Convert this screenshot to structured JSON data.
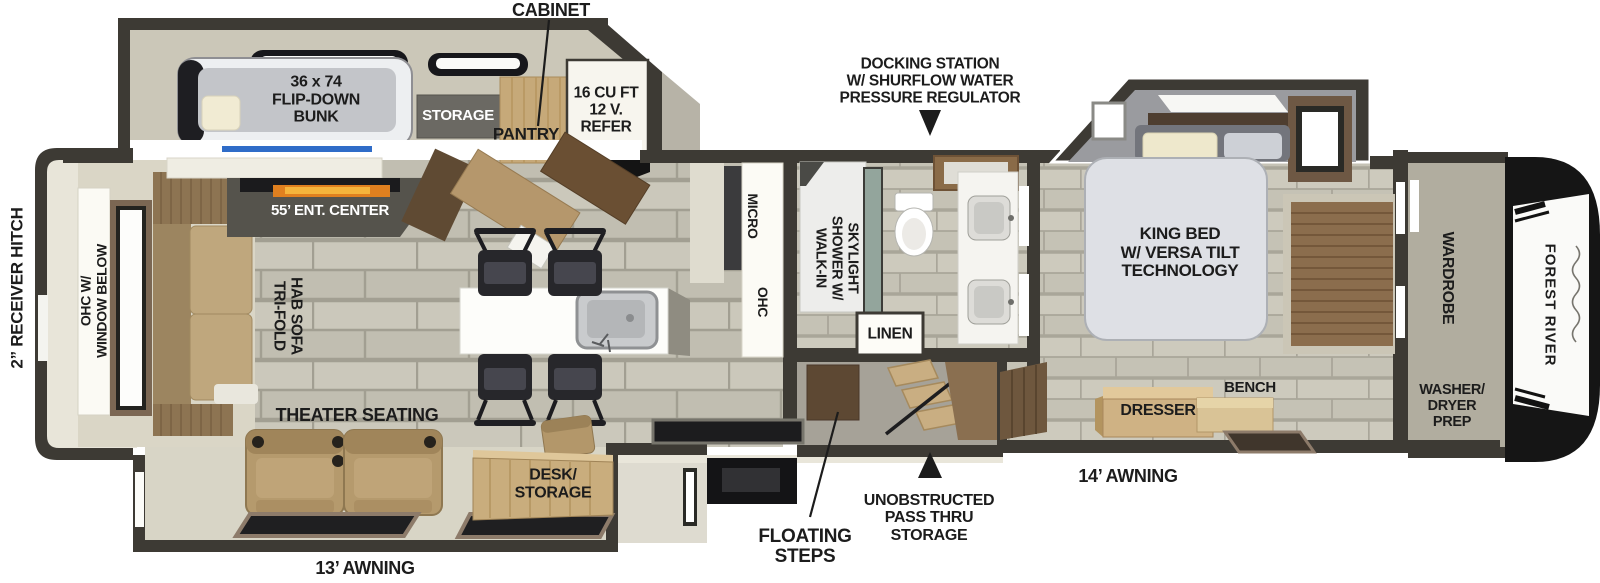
{
  "brand": "FOREST RIVER",
  "colors": {
    "wall": "#3d3a34",
    "accent_blue": "#2f6cc8",
    "flame_orange": "#e0801f",
    "wood_tan": "#c9ad7d",
    "label_text": "#1c1c1c"
  },
  "labels": {
    "cabinet": "CABINET",
    "bunk": "36 x 74\nFLIP-DOWN\nBUNK",
    "storage": "STORAGE",
    "pantry": "PANTRY",
    "refer": "16 CU FT\n12 V.\nREFER",
    "docking": "DOCKING STATION\nW/ SHURFLOW WATER\nPRESSURE REGULATOR",
    "ent_center": "55’ ENT. CENTER",
    "receiver_hitch": "2” RECEIVER HITCH",
    "ohc_window": [
      "OHC W/",
      "WINDOW BELOW"
    ],
    "tri_fold": [
      "TRI-FOLD",
      "HAB SOFA"
    ],
    "micro": "MICRO",
    "ohc": "OHC",
    "shower": [
      "WALK-IN",
      "SHOWER W/",
      "SKYLIGHT"
    ],
    "linen": "LINEN",
    "king_bed": "KING BED\nW/ VERSA TILT\nTECHNOLOGY",
    "wardrobe": "WARDROBE",
    "washer_dryer": "WASHER/\nDRYER\nPREP",
    "bench": "BENCH",
    "dresser": "DRESSER",
    "theater": "THEATER SEATING",
    "desk": "DESK/\nSTORAGE",
    "awning_13": "13’ AWNING",
    "awning_14": "14’ AWNING",
    "floating_steps": "FLOATING\nSTEPS",
    "pass_thru": "UNOBSTRUCTED\nPASS THRU\nSTORAGE",
    "forest_river": "FOREST RIVER"
  }
}
